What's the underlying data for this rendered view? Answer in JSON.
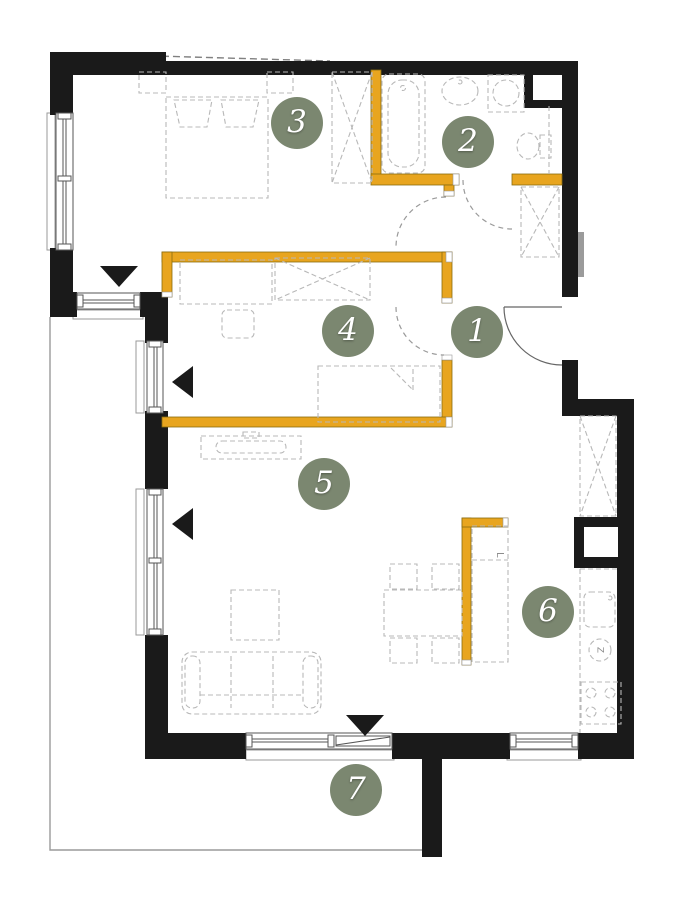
{
  "floor_plan": {
    "rooms": [
      {
        "number": "1"
      },
      {
        "number": "2"
      },
      {
        "number": "3"
      },
      {
        "number": "4"
      },
      {
        "number": "5"
      },
      {
        "number": "6"
      },
      {
        "number": "7"
      }
    ],
    "labels": {
      "fridge": "L",
      "dishwasher": "Z"
    },
    "colors": {
      "wall": "#1a1a1a",
      "accent_wall": "#e8a51f",
      "badge": "#7b8770",
      "furniture_line": "#b8b8b8"
    }
  }
}
